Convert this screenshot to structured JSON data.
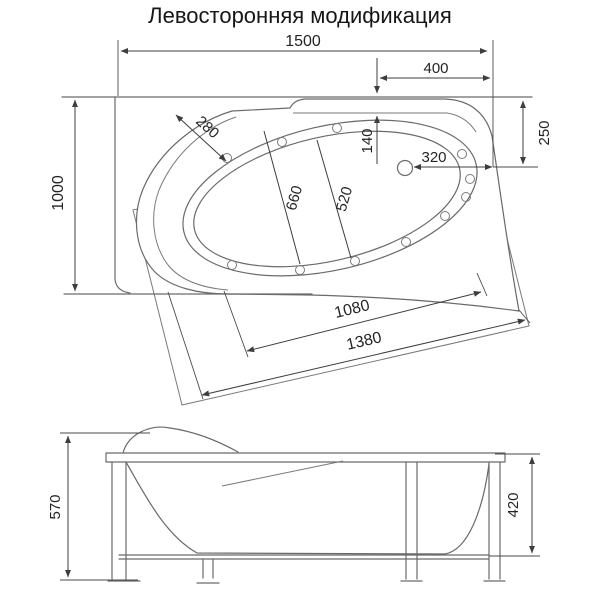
{
  "title": "Левосторонняя модификация",
  "colors": {
    "line": "#6a6a6a",
    "dimension": "#3d3d3d",
    "text": "#242424",
    "background": "#ffffff"
  },
  "top_view": {
    "dims": {
      "length_overall": "1500",
      "corner_offset": "400",
      "width_overall": "1000",
      "rim_width": "280",
      "wall_to_bowl": "140",
      "wall_to_drain": "250",
      "drain_to_edge": "320",
      "bowl_width_major": "660",
      "bowl_width_minor": "520",
      "front_span_inner": "1080",
      "front_span_outer": "1380"
    }
  },
  "side_view": {
    "dims": {
      "height_total": "570",
      "frame_height": "420"
    }
  }
}
